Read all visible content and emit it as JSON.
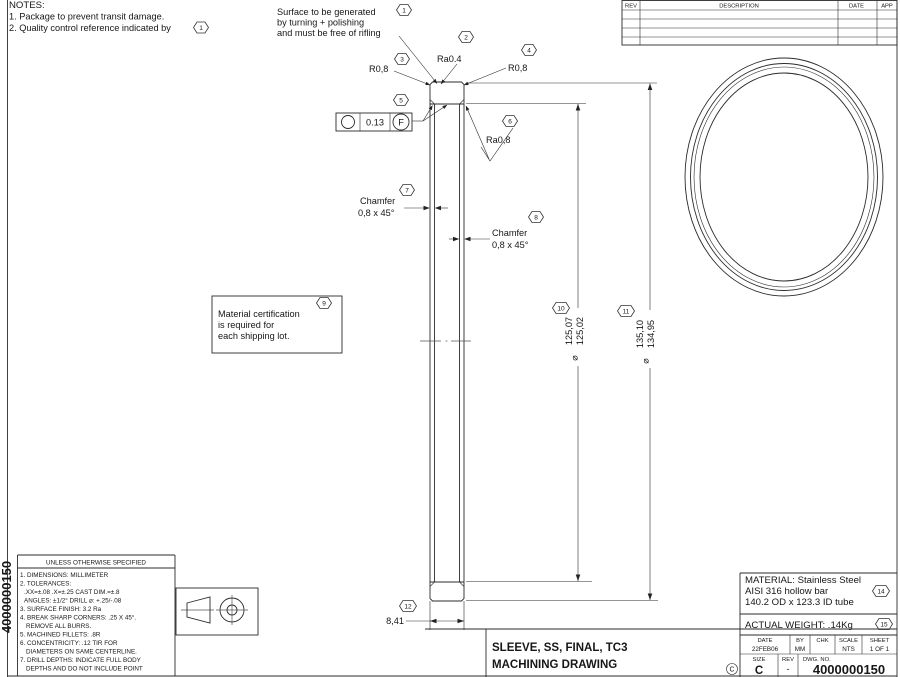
{
  "notes": {
    "title": "NOTES:",
    "line1": "1. Package to prevent transit damage.",
    "line2": "2. Quality control reference indicated by"
  },
  "balloons": {
    "n1": "1",
    "n2": "2",
    "n3": "3",
    "n4": "4",
    "n5": "5",
    "n6": "6",
    "n7": "7",
    "n8": "8",
    "n9": "9",
    "n10": "10",
    "n11": "11",
    "n12": "12",
    "n14": "14",
    "n15": "15"
  },
  "callouts": {
    "surface_note": [
      "Surface to be generated",
      "by turning + polishing",
      "and must be free of rifling"
    ],
    "ra04": "Ra0.4",
    "r08_left": "R0,8",
    "r08_right": "R0,8",
    "fcf": {
      "symbol_name": "circularity-symbol",
      "tolerance": "0.13",
      "datum": "F"
    },
    "ra08": "Ra0,8",
    "chamfer_left": [
      "Chamfer",
      "0,8 x 45°"
    ],
    "chamfer_right": [
      "Chamfer",
      "0,8 x 45°"
    ],
    "material_cert": [
      "Material certification",
      "is required for",
      "each shipping lot."
    ]
  },
  "dimensions": {
    "inner": {
      "symbol": "⌀",
      "upper": "125,07",
      "lower": "125,02"
    },
    "outer": {
      "symbol": "⌀",
      "upper": "135,10",
      "lower": "134,95"
    },
    "width": "8,41"
  },
  "rev_table": {
    "headers": [
      "REV",
      "DESCRIPTION",
      "DATE",
      "APP"
    ]
  },
  "tolerance_block": {
    "title": "UNLESS OTHERWISE SPECIFIED",
    "lines": [
      "1. DIMENSIONS: MILLIMETER",
      "2. TOLERANCES:",
      ".XX=±.08   .X=±.25   CAST DIM.=±.8",
      "ANGLES: ±1/2°   DRILL ⌀: +.25/-.08",
      "3. SURFACE FINISH: 3.2 Ra",
      "4. BREAK SHARP CORNERS: .25 X 45°.",
      "REMOVE ALL BURRS.",
      "5. MACHINED FILLETS: .8R",
      "6. CONCENTRICITY: .12 TIR FOR",
      "DIAMETERS ON SAME CENTERLINE.",
      "7. DRILL DEPTHS: INDICATE FULL BODY",
      "DEPTHS AND DO NOT INCLUDE POINT"
    ]
  },
  "margin": {
    "doc_number": "4000000150"
  },
  "title_block": {
    "part_title": "SLEEVE, SS, FINAL, TC3",
    "drawing_type": "MACHINING DRAWING",
    "copyright": "C",
    "material": [
      "MATERIAL: Stainless Steel",
      "AISI 316 hollow bar",
      "140.2 OD x 123.3 ID tube"
    ],
    "weight": "ACTUAL WEIGHT: .14Kg",
    "labels": {
      "date": "DATE",
      "by": "BY",
      "chk": "CHK",
      "scale": "SCALE",
      "sheet": "SHEET",
      "size": "SIZE",
      "rev": "REV",
      "dwg": "DWG. NO."
    },
    "values": {
      "date": "22FEB06",
      "by": "MM",
      "chk": "",
      "scale": "NTS",
      "sheet": "1 OF 1",
      "size": "C",
      "rev": "-",
      "dwg": "4000000150"
    }
  }
}
